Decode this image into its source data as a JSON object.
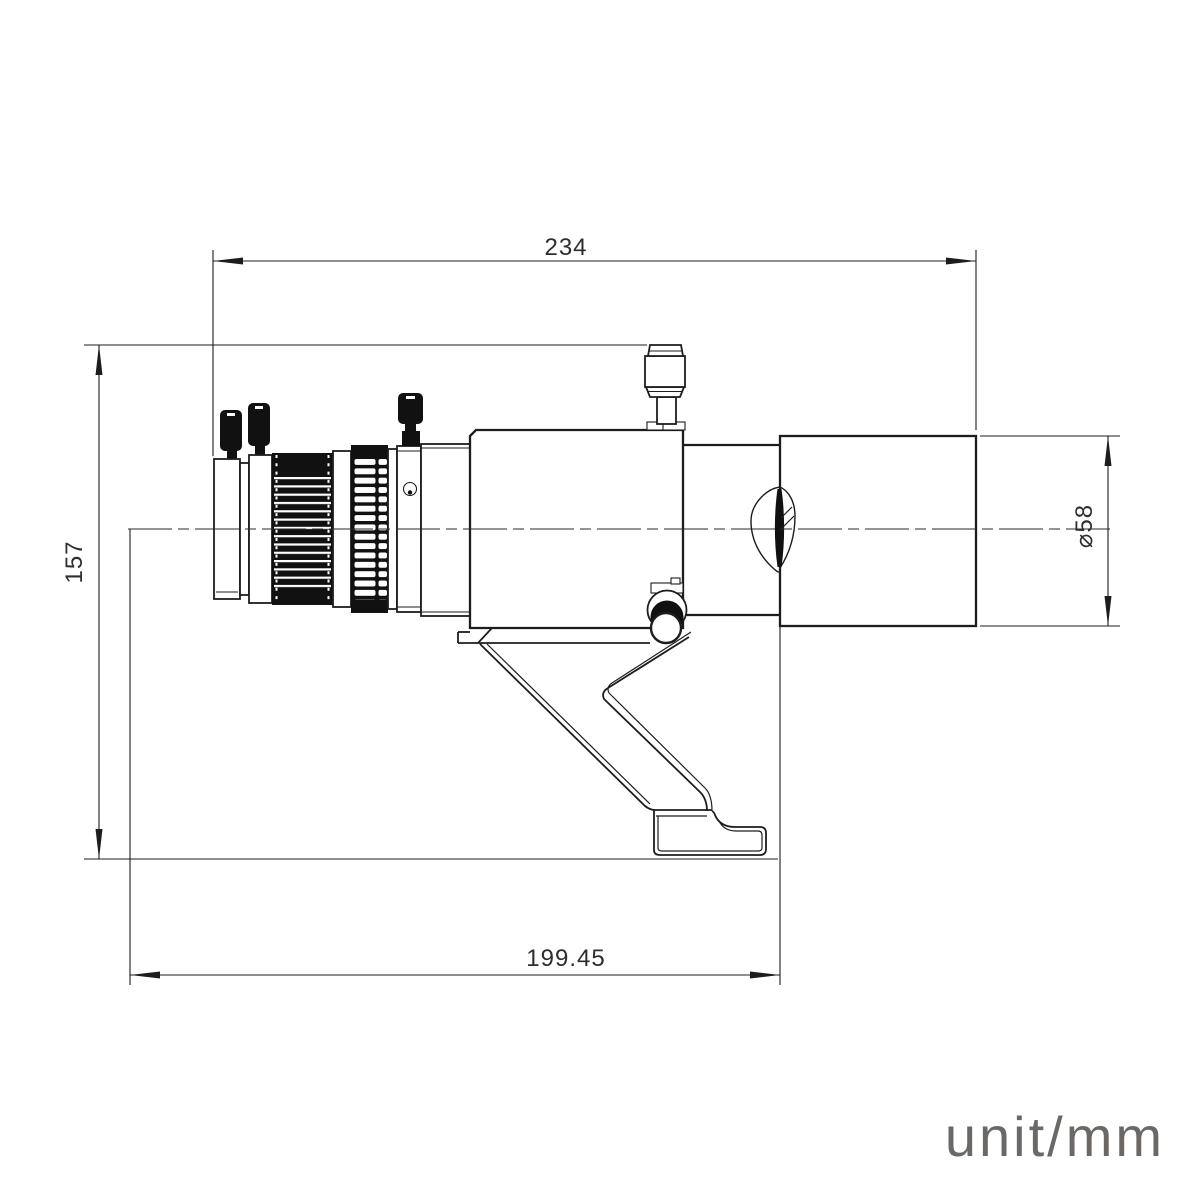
{
  "drawing": {
    "type": "technical-drawing",
    "subject": "guide-scope-side-view",
    "unit_label": "unit/mm",
    "dimensions": {
      "overall_length": "234",
      "overall_height": "157",
      "tube_diameter": "⌀58",
      "back_length": "199.45"
    },
    "colors": {
      "line": "#1d1d1d",
      "dimension_text": "#2e2e2e",
      "unit_text": "#6b6866",
      "background": "#ffffff"
    }
  }
}
